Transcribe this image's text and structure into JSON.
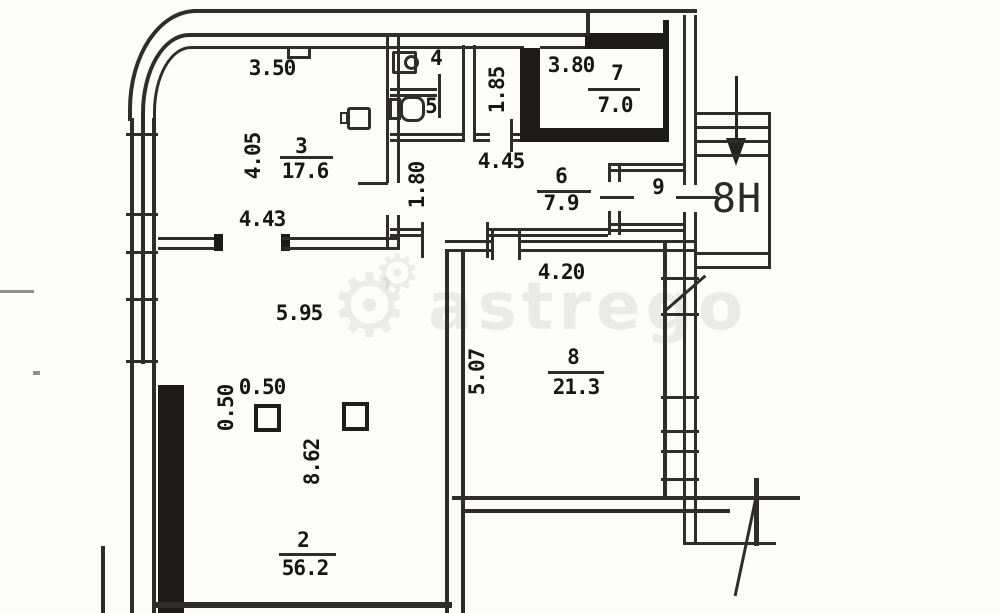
{
  "watermark": {
    "brand": "astrego",
    "gear_icon": "⚙"
  },
  "unit_label": "8Н",
  "rooms": {
    "r2": {
      "number": "2",
      "area": "56.2"
    },
    "r3": {
      "number": "3",
      "area": "17.6"
    },
    "r4": {
      "number": "4"
    },
    "r5": {
      "number": "5"
    },
    "r6": {
      "number": "6",
      "area": "7.9"
    },
    "r7": {
      "number": "7",
      "area": "7.0"
    },
    "r8": {
      "number": "8",
      "area": "21.3"
    },
    "r9": {
      "number": "9"
    }
  },
  "dimensions": {
    "room3_top": "3.50",
    "room3_left": "4.05",
    "room3_bottom": "4.43",
    "alcove_height": "1.85",
    "room7_top": "3.80",
    "hall_width": "4.45",
    "hall_height": "1.80",
    "room8_top": "4.20",
    "room8_left": "5.07",
    "room2_width": "5.95",
    "column_offset_h": "0.50",
    "column_offset_v": "0.50",
    "room2_height": "8.62"
  }
}
